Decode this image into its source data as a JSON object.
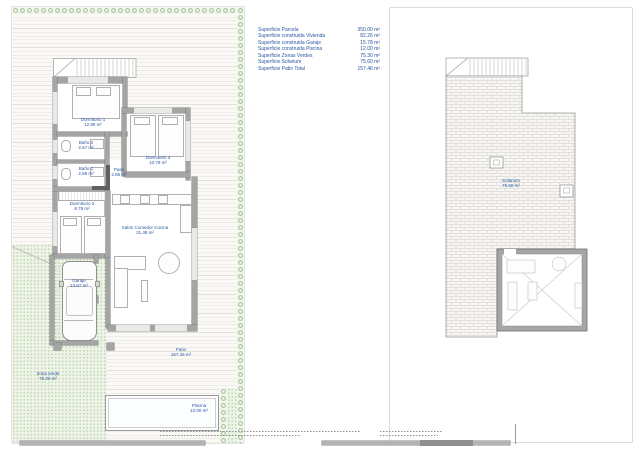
{
  "legend": {
    "rows": [
      {
        "label": "Superficie Parcela",
        "value": "350.00 m²"
      },
      {
        "label": "Superficie construida Vivienda",
        "value": "82.26 m²"
      },
      {
        "label": "Superficie construida Garaje",
        "value": "15.78 m²"
      },
      {
        "label": "Superficie construida Piscina",
        "value": "12.00 m²"
      },
      {
        "label": "Superficie Zonas Verdes",
        "value": "75.30 m²"
      },
      {
        "label": "Superficie Solarium",
        "value": "75.60 m²"
      },
      {
        "label": "Superficie Patio Total",
        "value": "157.46 m²"
      }
    ]
  },
  "ground_floor": {
    "rooms": [
      {
        "name": "Dormitorio 1",
        "area": "12.98 m²"
      },
      {
        "name": "Baño 2",
        "area": "2.67 m²"
      },
      {
        "name": "Dormitorio 3",
        "area": "10.79 m²"
      },
      {
        "name": "Baño 1",
        "area": "2.58 m²"
      },
      {
        "name": "Paso",
        "area": "2.85 m²"
      },
      {
        "name": "Dormitorio 2",
        "area": "8.78 m²"
      },
      {
        "name": "Salón Comedor Cocina",
        "area": "31.48 m²"
      },
      {
        "name": "Garaje",
        "area": "13.67 m²"
      },
      {
        "name": "Patio",
        "area": "157.46 m²"
      },
      {
        "name": "Zona verde",
        "area": "75.30 m²"
      },
      {
        "name": "Piscina",
        "area": "12.00 m²"
      }
    ]
  },
  "roof_plan": {
    "room": {
      "name": "Solarium",
      "area": "75.60 m²"
    }
  },
  "colors": {
    "label_blue": "#2a56a5",
    "wall_gray": "#a5a5a5",
    "hedge_green": "#a9c79b",
    "green_zone_bg": "#edf3e6"
  }
}
